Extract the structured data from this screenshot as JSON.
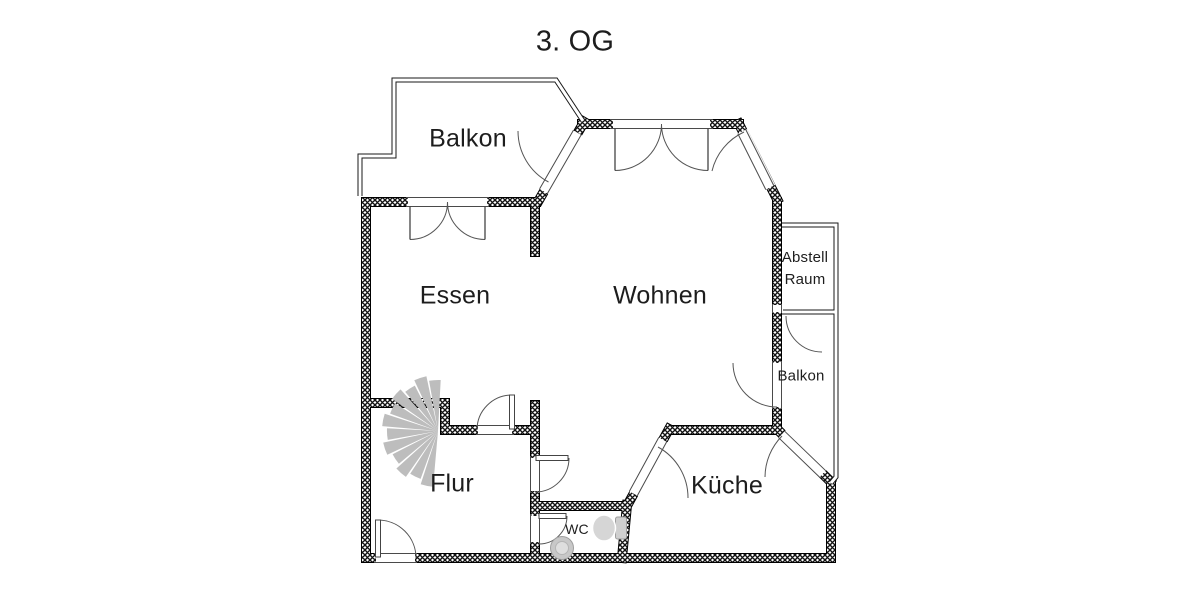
{
  "title": "3. OG",
  "floor_plan": {
    "rooms": {
      "balkon_top": "Balkon",
      "essen": "Essen",
      "wohnen": "Wohnen",
      "abstell_line1": "Abstell",
      "abstell_line2": "Raum",
      "balkon_right": "Balkon",
      "flur": "Flur",
      "kueche": "Küche",
      "wc": "WC"
    },
    "icons": {
      "stairs": "spiral-stairs-icon",
      "toilet": "toilet-icon",
      "sink": "sink-icon"
    },
    "colors": {
      "background": "#ffffff",
      "wall": "#111111",
      "door_line": "#555555",
      "stair_gray": "#bdbdbd",
      "fixture_gray": "#d6d6d6",
      "fixture_outline": "#9e9e9e",
      "text": "#1d1d1d"
    }
  }
}
